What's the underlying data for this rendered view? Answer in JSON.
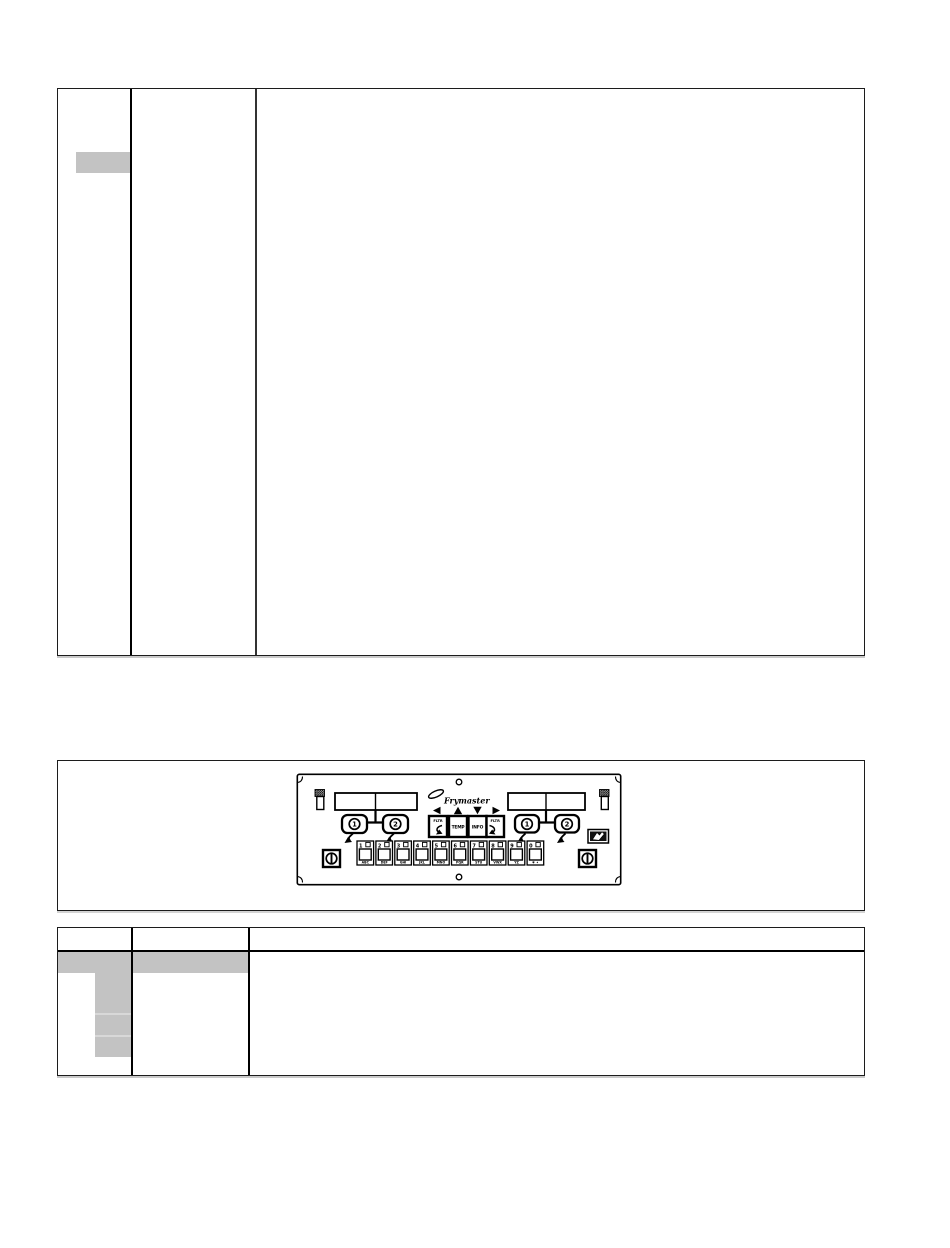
{
  "colors": {
    "highlight_gray": "#c3c3c3",
    "table_border": "#000000",
    "panel_ink": "#000000",
    "page_background": "#ffffff"
  },
  "panel": {
    "brand": "Frymaster",
    "vat_buttons": {
      "left": [
        "1",
        "2"
      ],
      "right": [
        "1",
        "2"
      ]
    },
    "nav_buttons": [
      {
        "label": "FLTR",
        "arrow": "left"
      },
      {
        "label": "TEMP",
        "arrow": "up"
      },
      {
        "label": "INFO",
        "arrow": "down"
      },
      {
        "label": "FLTR",
        "arrow": "right"
      }
    ],
    "keypad": [
      {
        "digit": "1",
        "letters": "ABC"
      },
      {
        "digit": "2",
        "letters": "DEF"
      },
      {
        "digit": "3",
        "letters": "GHI"
      },
      {
        "digit": "4",
        "letters": "JKL"
      },
      {
        "digit": "5",
        "letters": "MNO"
      },
      {
        "digit": "6",
        "letters": "PQR"
      },
      {
        "digit": "7",
        "letters": "STU"
      },
      {
        "digit": "8",
        "letters": "VWX"
      },
      {
        "digit": "9",
        "letters": "YZ"
      },
      {
        "digit": "0",
        "letters": "✱ ✦"
      }
    ]
  }
}
